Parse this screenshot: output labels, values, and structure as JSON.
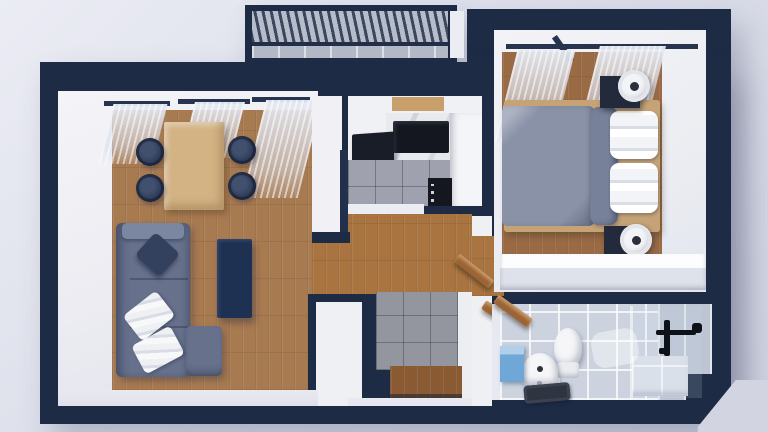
{
  "scene": {
    "type": "3d-floorplan-render",
    "view": "top-down dollhouse view of a one-bedroom apartment",
    "background_gradient": [
      "#ebecf4",
      "#d0d3e1"
    ]
  },
  "palette": {
    "wall": "#1d2b45",
    "wall_face": "#f1f1f5",
    "wood_living": "#a87a50",
    "wood_hall": "#a9743f",
    "wood_bedroom": "#9a6a44",
    "bed_frame_wood": "#c6a377",
    "tile_kitchen": "#9fa2ae",
    "tile_entry": "#94969f",
    "tile_bath": "#ccd3df",
    "tile_bath_wall": "#bdc5d3",
    "sofa": "#67718c",
    "sofa_armrest": "#7b86a0",
    "coffee_table": "#1f3153",
    "dining_table": "#d3b384",
    "chair": "#2c3a57",
    "duvet": "#8a92a7",
    "bolster": "#78819a",
    "pillow_white": "#f4f5f8",
    "nightstand": "#232a3b",
    "dresser": "#eff1f5",
    "counter": "#f4f5f8",
    "appliance_black": "#14171f",
    "door_wood": "#9c6434",
    "mat_wood": "#8a5a33",
    "bath_mat": "#2e3440",
    "laundry_box_blue": "#6fa8d6",
    "fixture_black": "#0e1118",
    "porcelain": "#f6f6f8",
    "balcony_floor": "#b3b8c6",
    "curtain": "#dfe3ec"
  },
  "rooms": {
    "balcony": {
      "name": "balcony",
      "features": [
        "slatted pergola roof",
        "gray tile floor",
        "dark railing frame"
      ]
    },
    "living_room": {
      "name": "living room",
      "features": [
        "l-shaped gray sofa",
        "navy throw pillow",
        "two white striped pillows",
        "navy coffee table",
        "light wood dining table",
        "four navy round chairs",
        "three sheer window curtains",
        "wood plank floor"
      ]
    },
    "kitchen": {
      "name": "kitchen",
      "features": [
        "black cooktop on marble counter",
        "black counter appliance",
        "white l-shaped counter",
        "black oven front with knobs",
        "gray tile floor",
        "balcony door threshold"
      ]
    },
    "hallway": {
      "name": "hallway",
      "features": [
        "wood plank floor",
        "open bedroom door leaf",
        "open bathroom door leaf"
      ]
    },
    "entry": {
      "name": "entry",
      "features": [
        "gray tile floor",
        "wooden doormat at entrance door"
      ]
    },
    "bedroom": {
      "name": "bedroom",
      "features": [
        "double bed with gray duvet",
        "gray bolster pillow",
        "two stacks of white pillows",
        "light wood bed frame",
        "two dark nightstands",
        "two round white fans",
        "long white dresser",
        "window curtains with dark rail",
        "wood plank floor"
      ]
    },
    "bathroom": {
      "name": "bathroom",
      "features": [
        "white toilet",
        "white wall sink with tap",
        "dark bath mat",
        "blue laundry box",
        "wooden shelf",
        "black shower mixer",
        "glass shower screen",
        "tiled bench",
        "white tile floor and walls"
      ]
    }
  }
}
